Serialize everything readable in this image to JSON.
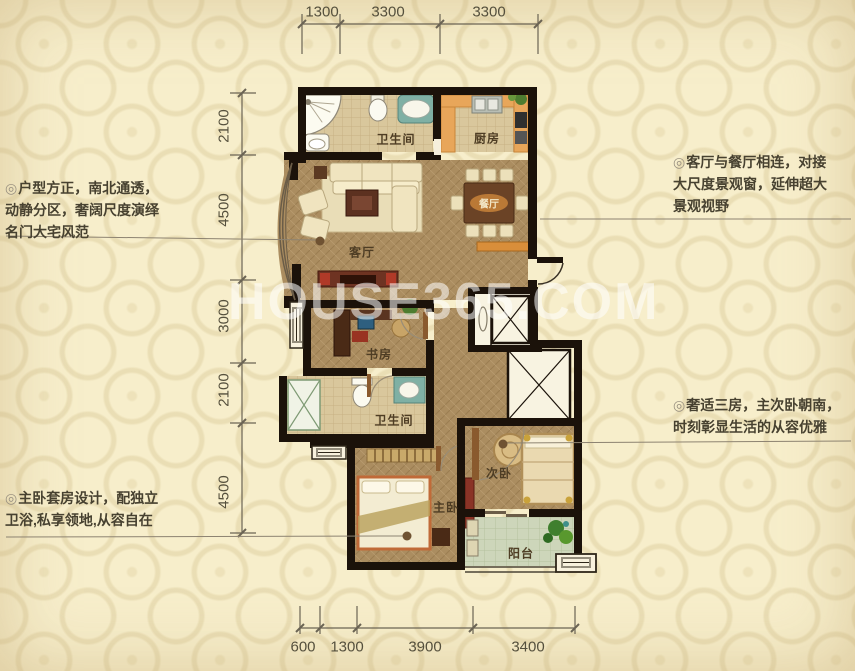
{
  "watermark": "HOUSE365.COM",
  "bullet": "◎",
  "callouts": {
    "left_top": {
      "lines": [
        "户型方正，南北通透，",
        "动静分区，奢阔尺度演绎",
        "名门大宅风范"
      ]
    },
    "left_bottom": {
      "lines": [
        "主卧套房设计，配独立",
        "卫浴,私享领地,从容自在"
      ]
    },
    "right_top": {
      "lines": [
        "客厅与餐厅相连，对接",
        "大尺度景观窗，延伸超大",
        "景观视野"
      ]
    },
    "right_bottom": {
      "lines": [
        "奢适三房，主次卧朝南，",
        "时刻彰显生活的从容优雅"
      ]
    }
  },
  "dimensions": {
    "top": [
      "1300",
      "3300",
      "3300"
    ],
    "left": [
      "2100",
      "4500",
      "3000",
      "2100",
      "4500"
    ],
    "bottom": [
      "600",
      "1300",
      "3900",
      "3400"
    ]
  },
  "rooms": {
    "bath1": "卫生间",
    "kitchen": "厨房",
    "living": "客厅",
    "dining": "餐厅",
    "study": "书房",
    "bath2": "卫生间",
    "bedroom2": "次卧",
    "master": "主卧",
    "balcony": "阳台"
  },
  "colors": {
    "background": "#f7eecb",
    "wall": "#1b120a",
    "wood_floor": "#ab8d60",
    "tile_floor": "#d9c79c",
    "balcony_floor": "#cdd6ba",
    "kitchen_counter": "#e8a65a",
    "accent_red": "#8a3326",
    "teal_fixture": "#7fb0a4",
    "text": "#474130",
    "watermark": "#ffffff"
  }
}
